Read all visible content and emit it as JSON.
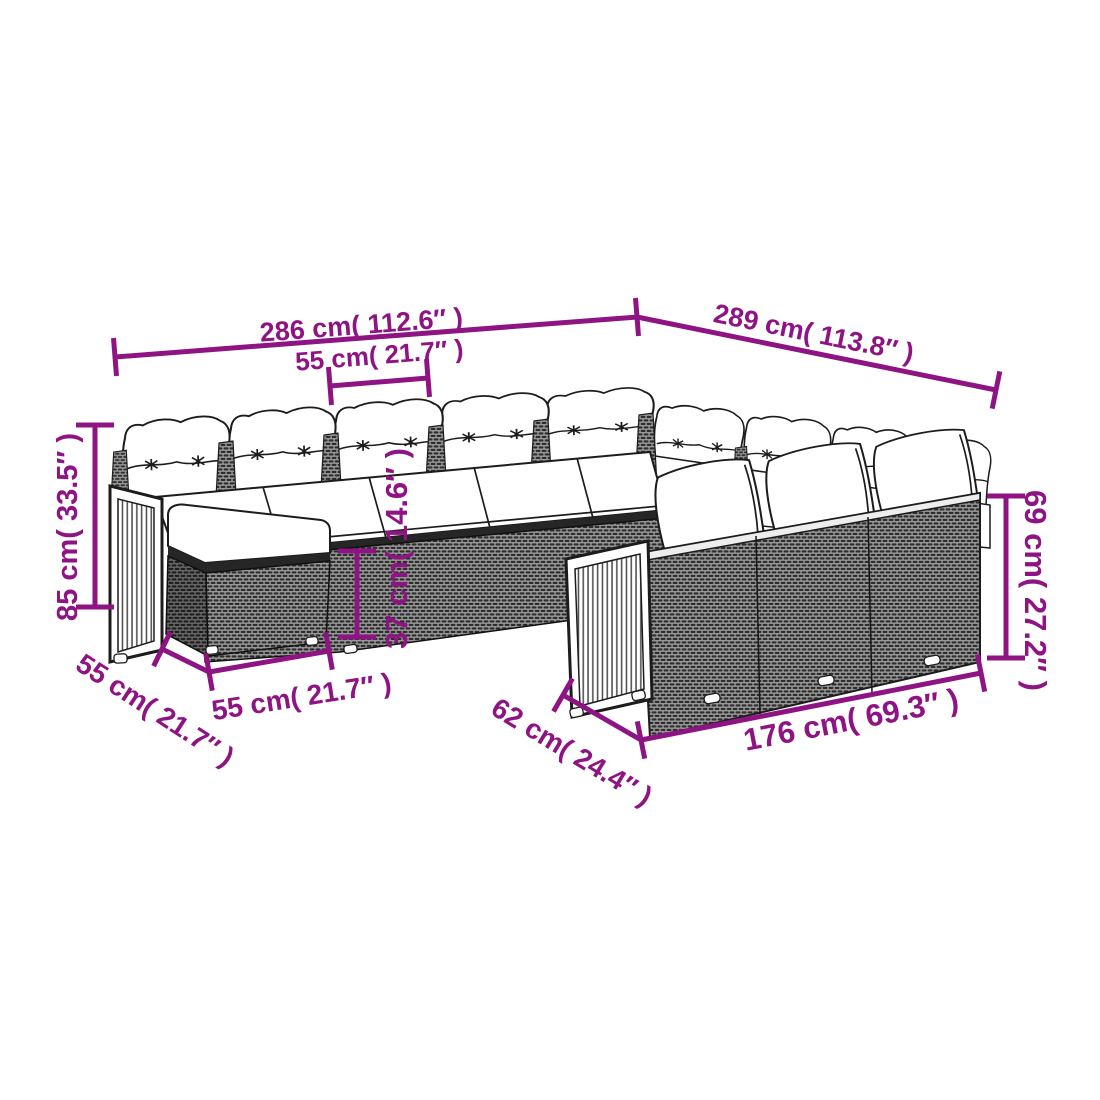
{
  "figure": {
    "type": "product-dimension-diagram",
    "subject": "U-shaped poly rattan garden lounge set with cushions, acacia wood slat arm panels and ottoman"
  },
  "colors": {
    "accent": "#8e1383",
    "ink": "#1c1c1c",
    "background": "#ffffff",
    "rattan_dark": "#2d2d2d",
    "rattan_light": "#979797"
  },
  "dimensions": {
    "back_left_width": "286 cm( 112.6″ )",
    "back_right_width": "289 cm( 113.8″ )",
    "seat_module_width": "55 cm( 21.7″ )",
    "overall_height": "85 cm( 33.5″ )",
    "seat_height": "37 cm( 14.6″ )",
    "backrest_height": "69 cm( 27.2″ )",
    "ottoman_depth": "55 cm( 21.7″ )",
    "ottoman_width": "55 cm( 21.7″ )",
    "seat_depth": "62 cm( 24.4″ )",
    "front_section_width": "176 cm( 69.3″ )"
  }
}
